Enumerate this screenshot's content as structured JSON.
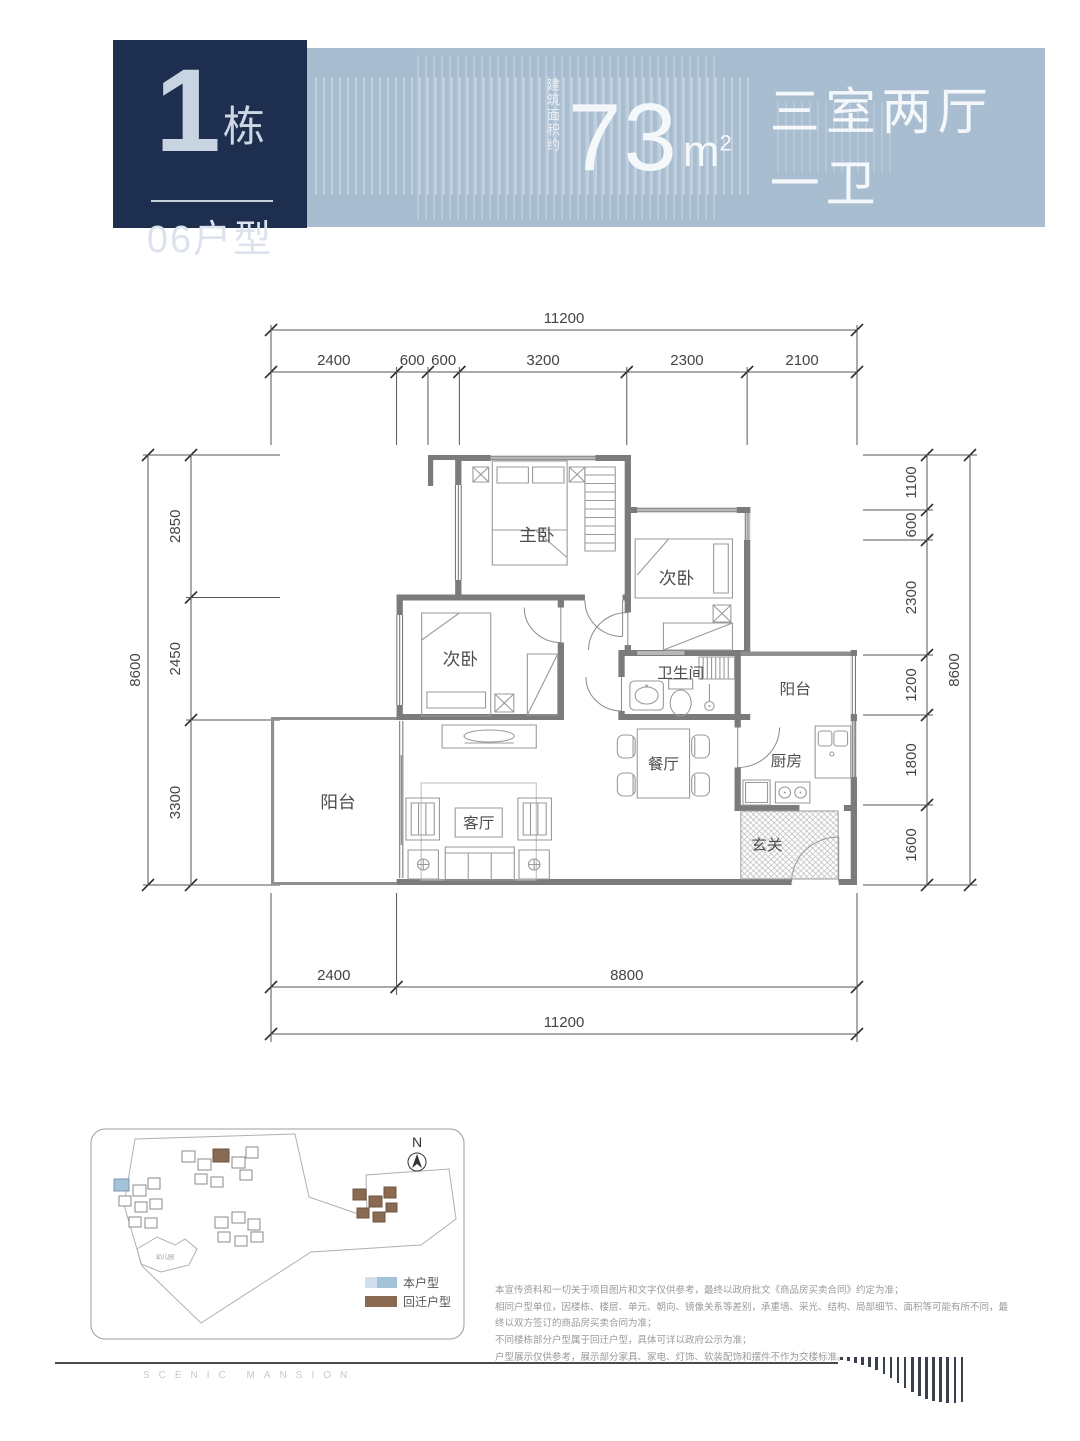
{
  "header": {
    "building_number": "1",
    "building_suffix": "栋",
    "unit_label": "06户型",
    "area_prefix": "建筑面积约",
    "area_value": "73",
    "area_unit": "m",
    "area_sup": "2",
    "layout_desc": "三室两厅一卫",
    "colors": {
      "box_bg": "#1e2e4e",
      "banner_bg": "#a9bdd1"
    }
  },
  "floor_plan": {
    "rooms": {
      "master": "主卧",
      "bedroom_a": "次卧",
      "bedroom_b": "次卧",
      "bathroom": "卫生间",
      "balcony_a": "阳台",
      "balcony_b": "阳台",
      "dining": "餐厅",
      "kitchen": "厨房",
      "foyer": "玄关",
      "living": "客厅"
    },
    "dimensions": {
      "top": {
        "overall": 11200,
        "segments": [
          2400,
          600,
          600,
          3200,
          2300,
          2100
        ]
      },
      "bottom": {
        "overall": 11200,
        "segments": [
          2400,
          8800
        ]
      },
      "left": {
        "overall": 8600,
        "segments": [
          2850,
          2450,
          3300
        ]
      },
      "right": {
        "overall": 8600,
        "segments": [
          1100,
          600,
          2300,
          1200,
          1800,
          1600
        ]
      }
    }
  },
  "site_plan": {
    "north_label": "N",
    "kindergarten_label": "幼儿园",
    "legend": [
      {
        "label": "本户型",
        "color": "#a3c3d9"
      },
      {
        "label": "回迁户型",
        "color": "#8a6a50"
      }
    ]
  },
  "disclaimer": {
    "lines": [
      "本宣传资料和一切关于项目图片和文字仅供参考，最终以政府批文《商品房买卖合同》约定为准；",
      "相同户型单位，因楼栋、楼层、单元、朝向、镜像关系等差别，承重墙、采光、结构、局部细节、面积等可能有所不同，最终以双方签订的商品房买卖合同为准；",
      "不同楼栋部分户型属于回迁户型，具体可详以政府公示为准；",
      "户型展示仅供参考，展示部分家具、家电、灯饰、软装配饰和摆件不作为交楼标准。"
    ]
  },
  "footer": {
    "brand": "SCENIC MANSION"
  }
}
